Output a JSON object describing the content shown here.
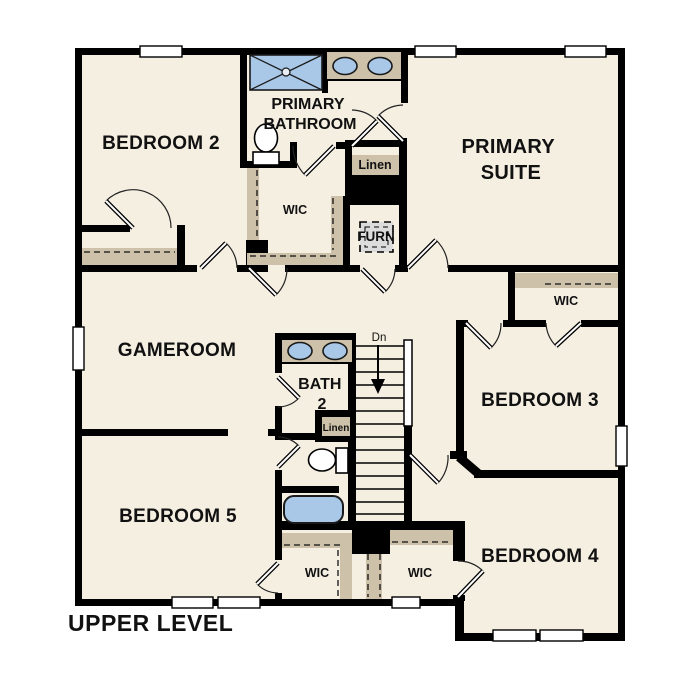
{
  "level_label": "UPPER LEVEL",
  "rooms": {
    "bedroom2": {
      "label": "BEDROOM 2"
    },
    "primary_bathroom": {
      "line1": "PRIMARY",
      "line2": "BATHROOM"
    },
    "primary_suite": {
      "line1": "PRIMARY",
      "line2": "SUITE"
    },
    "primary_wic": {
      "label": "WIC"
    },
    "primary_linen": {
      "label": "Linen"
    },
    "furnace": {
      "label": "FURN"
    },
    "gameroom": {
      "label": "GAMEROOM"
    },
    "bath2": {
      "line1": "BATH",
      "line2": "2"
    },
    "bath2_linen": {
      "label": "Linen"
    },
    "bedroom3": {
      "label": "BEDROOM 3"
    },
    "bedroom3_wic": {
      "label": "WIC"
    },
    "bedroom5": {
      "label": "BEDROOM 5"
    },
    "bedroom5_wic": {
      "label": "WIC"
    },
    "bedroom4": {
      "label": "BEDROOM 4"
    },
    "bedroom4_wic": {
      "label": "WIC"
    },
    "stairs": {
      "direction_label": "Dn"
    }
  },
  "fixtures": [
    "shower",
    "double-vanity-sinks",
    "toilet",
    "linen-shelf",
    "furnace-unit",
    "stairs-down",
    "bathtub",
    "closet-rods"
  ],
  "colors": {
    "wall": "#000000",
    "floor": "#f5efe2",
    "closet_shelf": "#cdc2a9",
    "fixture_blue": "#a9c7e6",
    "furnace_gray": "#dcdcdc",
    "background": "#ffffff"
  }
}
